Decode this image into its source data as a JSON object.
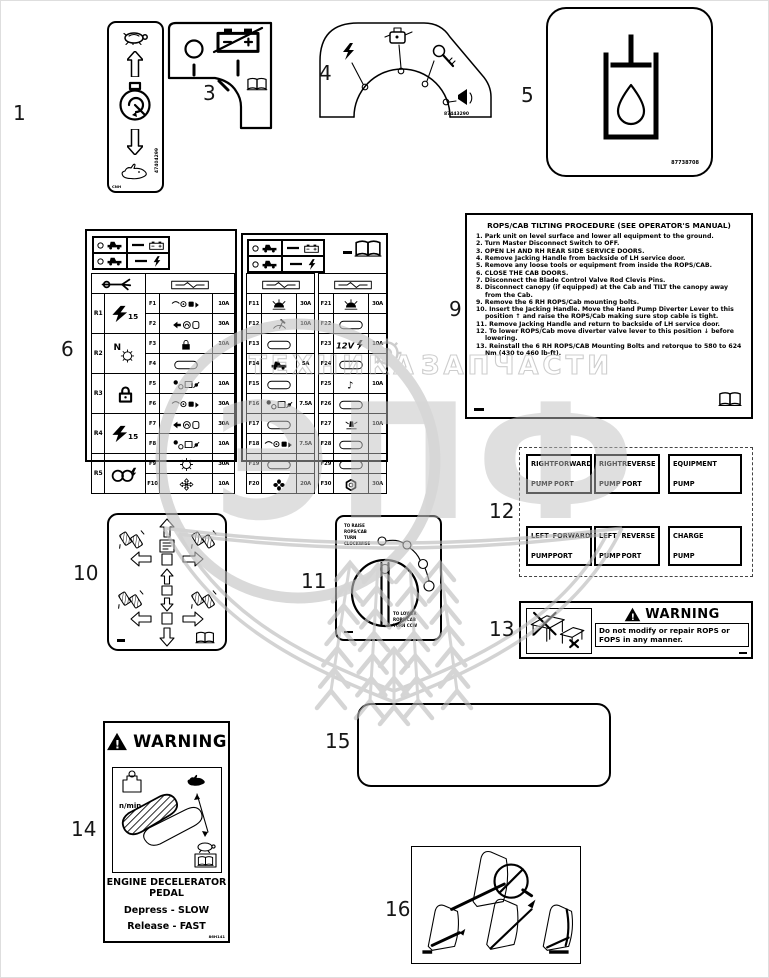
{
  "page": {
    "width": 769,
    "height": 978,
    "background": "#ffffff",
    "line_color": "#000000",
    "watermark_color": "#b9b9b9"
  },
  "callouts": {
    "n1": "1",
    "n3": "3",
    "n4": "4",
    "n5": "5",
    "n6": "6",
    "n9": "9",
    "n10": "10",
    "n11": "11",
    "n12": "12",
    "n13": "13",
    "n14": "14",
    "n15": "15",
    "n16": "16"
  },
  "watermark": {
    "word_left": "ТЕХНИКА",
    "word_right": "ЗАПЧАСТИ",
    "big_letters": "ЭПФ"
  },
  "decal1": {
    "part_number": "47404299",
    "brand": "CNH"
  },
  "decal4": {
    "part_number": "87443290"
  },
  "decal5": {
    "part_number": "87738708"
  },
  "decal6": {
    "left": {
      "relays": [
        {
          "id": "R1",
          "icon": "bolt15",
          "label": "15"
        },
        {
          "id": "R2",
          "icon": "gearN",
          "label": "N"
        },
        {
          "id": "R3",
          "icon": "lockbig",
          "label": ""
        },
        {
          "id": "R4",
          "icon": "bolt15",
          "label": "15"
        },
        {
          "id": "R5",
          "icon": "horns",
          "label": ""
        }
      ],
      "fuses": [
        {
          "id": "F1",
          "icon": "cluster1",
          "amp": "10A"
        },
        {
          "id": "F2",
          "icon": "cluster2",
          "amp": "30A"
        },
        {
          "id": "F3",
          "icon": "lock",
          "amp": "10A"
        },
        {
          "id": "F4",
          "icon": "pill",
          "amp": ""
        },
        {
          "id": "F5",
          "icon": "cluster3",
          "amp": "10A"
        },
        {
          "id": "F6",
          "icon": "cluster1",
          "amp": "30A"
        },
        {
          "id": "F7",
          "icon": "cluster2",
          "amp": "30A"
        },
        {
          "id": "F8",
          "icon": "cluster3",
          "amp": "10A"
        },
        {
          "id": "F9",
          "icon": "gear",
          "amp": "30A"
        },
        {
          "id": "F10",
          "icon": "cross",
          "amp": "10A"
        }
      ]
    },
    "right_a": [
      {
        "id": "F11",
        "icon": "lamp",
        "amp": "30A"
      },
      {
        "id": "F12",
        "icon": "wiper",
        "amp": "10A"
      },
      {
        "id": "F13",
        "icon": "pill",
        "amp": ""
      },
      {
        "id": "F14",
        "icon": "machine",
        "amp": "5A"
      },
      {
        "id": "F15",
        "icon": "pill",
        "amp": ""
      },
      {
        "id": "F16",
        "icon": "cluster3",
        "amp": "7.5A"
      },
      {
        "id": "F17",
        "icon": "pill",
        "amp": ""
      },
      {
        "id": "F18",
        "icon": "cluster1",
        "amp": "7.5A"
      },
      {
        "id": "F19",
        "icon": "pill",
        "amp": ""
      },
      {
        "id": "F20",
        "icon": "fan",
        "amp": "20A"
      }
    ],
    "right_b": [
      {
        "id": "F21",
        "icon": "lamp",
        "amp": "30A"
      },
      {
        "id": "F22",
        "icon": "pill",
        "amp": ""
      },
      {
        "id": "F23",
        "icon": "v12",
        "amp": "10A"
      },
      {
        "id": "F24",
        "icon": "pill",
        "amp": ""
      },
      {
        "id": "F25",
        "icon": "note",
        "amp": "10A"
      },
      {
        "id": "F26",
        "icon": "pill",
        "amp": ""
      },
      {
        "id": "F27",
        "icon": "beacon",
        "amp": "10A"
      },
      {
        "id": "F28",
        "icon": "pill",
        "amp": ""
      },
      {
        "id": "F29",
        "icon": "pill",
        "amp": ""
      },
      {
        "id": "F30",
        "icon": "hex",
        "amp": "30A"
      }
    ]
  },
  "decal9": {
    "title": "ROPS/CAB TILTING PROCEDURE (SEE OPERATOR'S MANUAL)",
    "steps": [
      "Park unit on level surface and lower all equipment to the ground.",
      "Turn Master Disconnect Switch to OFF.",
      "OPEN LH AND RH REAR SIDE SERVICE DOORS.",
      "Remove Jacking Handle from backside of LH service door.",
      "Remove any loose tools or equipment from inside the ROPS/CAB.",
      "CLOSE THE CAB DOORS.",
      "Disconnect the Blade Control Valve Rod Clevis Pins.",
      "Disconnect canopy (if equipped) at the Cab and TILT the canopy away from the Cab.",
      "Remove the 6 RH ROPS/Cab mounting bolts.",
      "Insert the Jacking Handle. Move the Hand Pump Diverter Lever to this position ↑ and raise the ROPS/Cab making sure stop cable is tight.",
      "Remove Jacking Handle and return to backside of LH service door.",
      "To lower ROPS/Cab move diverter valve lever to this position ↓ before lowering.",
      "Reinstall the 6 RH ROPS/CAB Mounting Bolts and retorque to 580 to 624 Nm (430 to 460 lb-ft)."
    ]
  },
  "decal11": {
    "top_lines": [
      "TO RAISE",
      "ROPS/CAB",
      "TURN",
      "CLOCKWISE"
    ],
    "bottom_lines": [
      "TO LOWER",
      "ROPS/CAB",
      "TURN CCW"
    ]
  },
  "decal12": {
    "boxes": [
      {
        "words": [
          "RIGHT",
          "FORWARD",
          "PUMP",
          "PORT"
        ]
      },
      {
        "words": [
          "RIGHT",
          "REVERSE",
          "PUMP",
          "PORT"
        ]
      },
      {
        "words": [
          "EQUIPMENT",
          "",
          "PUMP",
          ""
        ]
      },
      {
        "words": [
          "LEFT",
          "FORWARD",
          "PUMP",
          "PORT"
        ]
      },
      {
        "words": [
          "LEFT",
          "REVERSE",
          "PUMP",
          "PORT"
        ]
      },
      {
        "words": [
          "CHARGE",
          "",
          "PUMP",
          ""
        ]
      }
    ]
  },
  "decal13": {
    "title": "WARNING",
    "message": "Do not modify or repair ROPS or FOPS in any manner."
  },
  "decal14": {
    "title": "WARNING",
    "rpm_label": "n/min",
    "heading_line1": "ENGINE DECELERATOR",
    "heading_line2": "PEDAL",
    "action_line1": "Depress - SLOW",
    "action_line2": "Release - FAST",
    "code": "86H141"
  }
}
